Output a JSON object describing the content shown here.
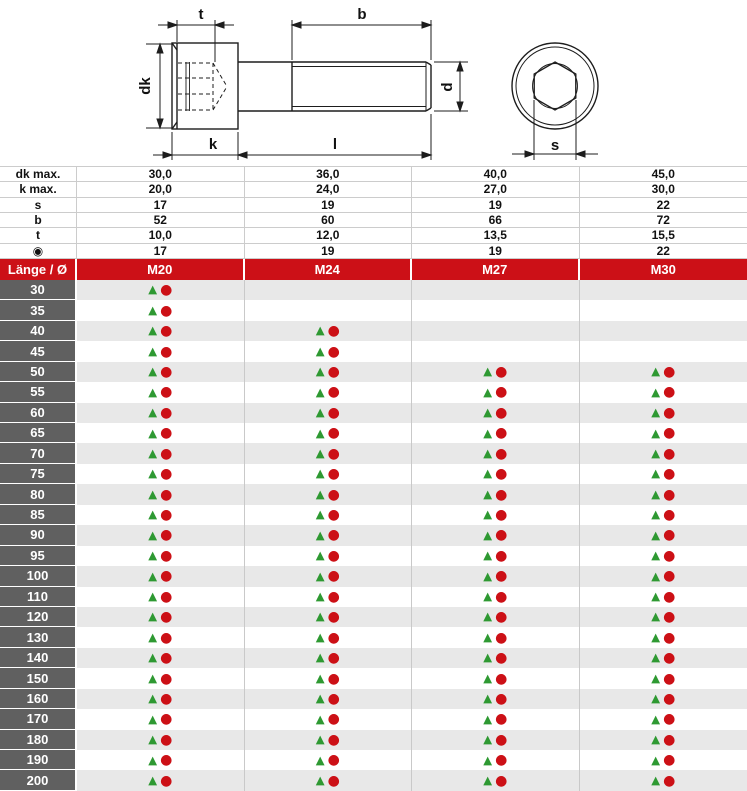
{
  "drawing": {
    "labels": {
      "t": "t",
      "b": "b",
      "dk": "dk",
      "k": "k",
      "l": "l",
      "d": "d",
      "s": "s"
    }
  },
  "spec_rows": [
    {
      "label": "dk max.",
      "icon": false,
      "values": [
        "30,0",
        "36,0",
        "40,0",
        "45,0"
      ]
    },
    {
      "label": "k max.",
      "icon": false,
      "values": [
        "20,0",
        "24,0",
        "27,0",
        "30,0"
      ]
    },
    {
      "label": "s",
      "icon": false,
      "values": [
        "17",
        "19",
        "19",
        "22"
      ]
    },
    {
      "label": "b",
      "icon": false,
      "values": [
        "52",
        "60",
        "66",
        "72"
      ]
    },
    {
      "label": "t",
      "icon": false,
      "values": [
        "10,0",
        "12,0",
        "13,5",
        "15,5"
      ]
    },
    {
      "label": "◉",
      "icon": true,
      "values": [
        "17",
        "19",
        "19",
        "22"
      ]
    }
  ],
  "header": {
    "length_label": "Länge / Ø",
    "columns": [
      "M20",
      "M24",
      "M27",
      "M30"
    ]
  },
  "markers": {
    "triangle_glyph": "▲",
    "circle_glyph": "●"
  },
  "availability_rows": [
    {
      "length": "30",
      "cells": [
        1,
        0,
        0,
        0
      ]
    },
    {
      "length": "35",
      "cells": [
        1,
        0,
        0,
        0
      ]
    },
    {
      "length": "40",
      "cells": [
        1,
        1,
        0,
        0
      ]
    },
    {
      "length": "45",
      "cells": [
        1,
        1,
        0,
        0
      ]
    },
    {
      "length": "50",
      "cells": [
        1,
        1,
        1,
        1
      ]
    },
    {
      "length": "55",
      "cells": [
        1,
        1,
        1,
        1
      ]
    },
    {
      "length": "60",
      "cells": [
        1,
        1,
        1,
        1
      ]
    },
    {
      "length": "65",
      "cells": [
        1,
        1,
        1,
        1
      ]
    },
    {
      "length": "70",
      "cells": [
        1,
        1,
        1,
        1
      ]
    },
    {
      "length": "75",
      "cells": [
        1,
        1,
        1,
        1
      ]
    },
    {
      "length": "80",
      "cells": [
        1,
        1,
        1,
        1
      ]
    },
    {
      "length": "85",
      "cells": [
        1,
        1,
        1,
        1
      ]
    },
    {
      "length": "90",
      "cells": [
        1,
        1,
        1,
        1
      ]
    },
    {
      "length": "95",
      "cells": [
        1,
        1,
        1,
        1
      ]
    },
    {
      "length": "100",
      "cells": [
        1,
        1,
        1,
        1
      ]
    },
    {
      "length": "110",
      "cells": [
        1,
        1,
        1,
        1
      ]
    },
    {
      "length": "120",
      "cells": [
        1,
        1,
        1,
        1
      ]
    },
    {
      "length": "130",
      "cells": [
        1,
        1,
        1,
        1
      ]
    },
    {
      "length": "140",
      "cells": [
        1,
        1,
        1,
        1
      ]
    },
    {
      "length": "150",
      "cells": [
        1,
        1,
        1,
        1
      ]
    },
    {
      "length": "160",
      "cells": [
        1,
        1,
        1,
        1
      ]
    },
    {
      "length": "170",
      "cells": [
        1,
        1,
        1,
        1
      ]
    },
    {
      "length": "180",
      "cells": [
        1,
        1,
        1,
        1
      ]
    },
    {
      "length": "190",
      "cells": [
        1,
        1,
        1,
        1
      ]
    },
    {
      "length": "200",
      "cells": [
        1,
        1,
        1,
        1
      ]
    }
  ],
  "colors": {
    "header_red": "#cc1017",
    "length_column_gray": "#606060",
    "alt_row_gray": "#e8e8e8",
    "grid_line": "#c9c9c9",
    "marker_green": "#2e9932",
    "marker_red": "#cc1016"
  }
}
